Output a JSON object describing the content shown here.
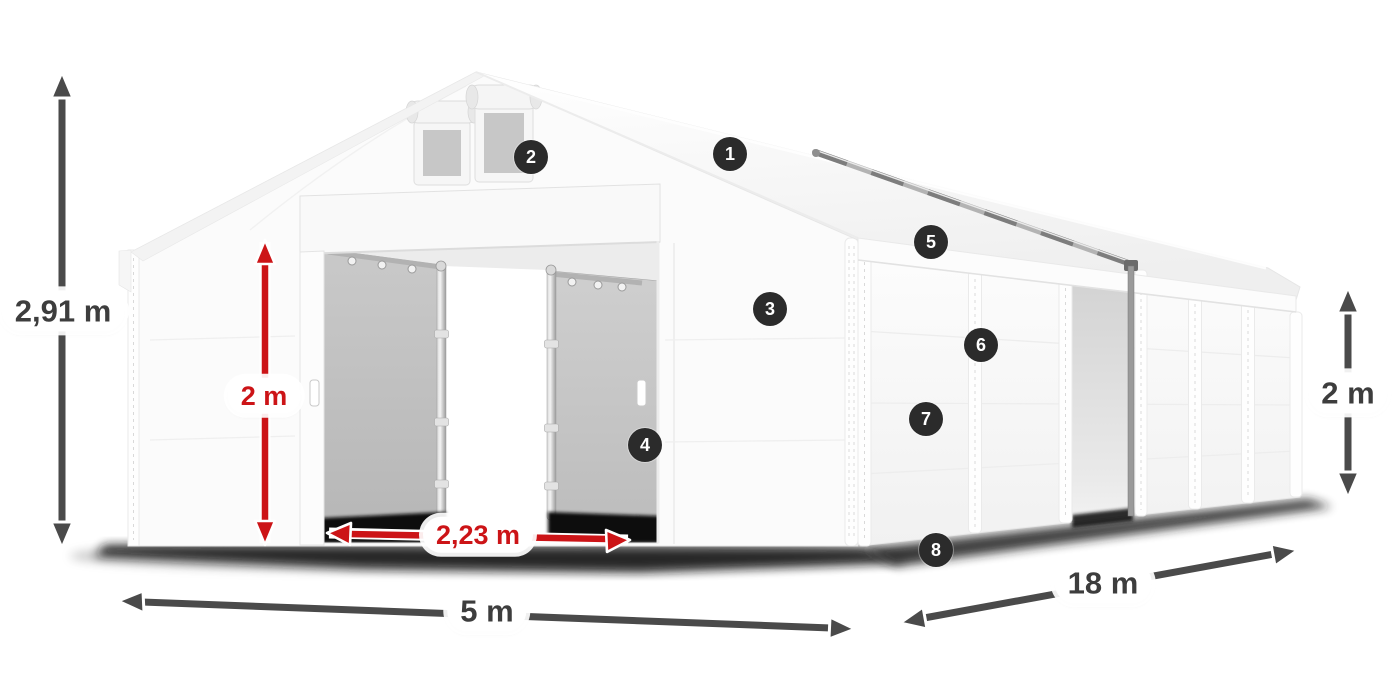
{
  "illustration": {
    "name": "white-marquee-tent-diagram"
  },
  "labels": {
    "total_height": "2,91 m",
    "door_height": "2 m",
    "door_width": "2,23 m",
    "front_width": "5 m",
    "length": "18 m",
    "side_wall_height": "2 m"
  },
  "callouts": [
    {
      "number": "1"
    },
    {
      "number": "2"
    },
    {
      "number": "3"
    },
    {
      "number": "4"
    },
    {
      "number": "5"
    },
    {
      "number": "6"
    },
    {
      "number": "7"
    },
    {
      "number": "8"
    }
  ],
  "colors": {
    "background": "#ffffff",
    "accent_red": "#cc1417",
    "arrow_dark": "#4a4a4a",
    "badge_background": "#2b2b2b",
    "label_text": "#3d3d3d",
    "tent_white": "#fbfbfb",
    "interior_gray": "#c4c4c4"
  }
}
